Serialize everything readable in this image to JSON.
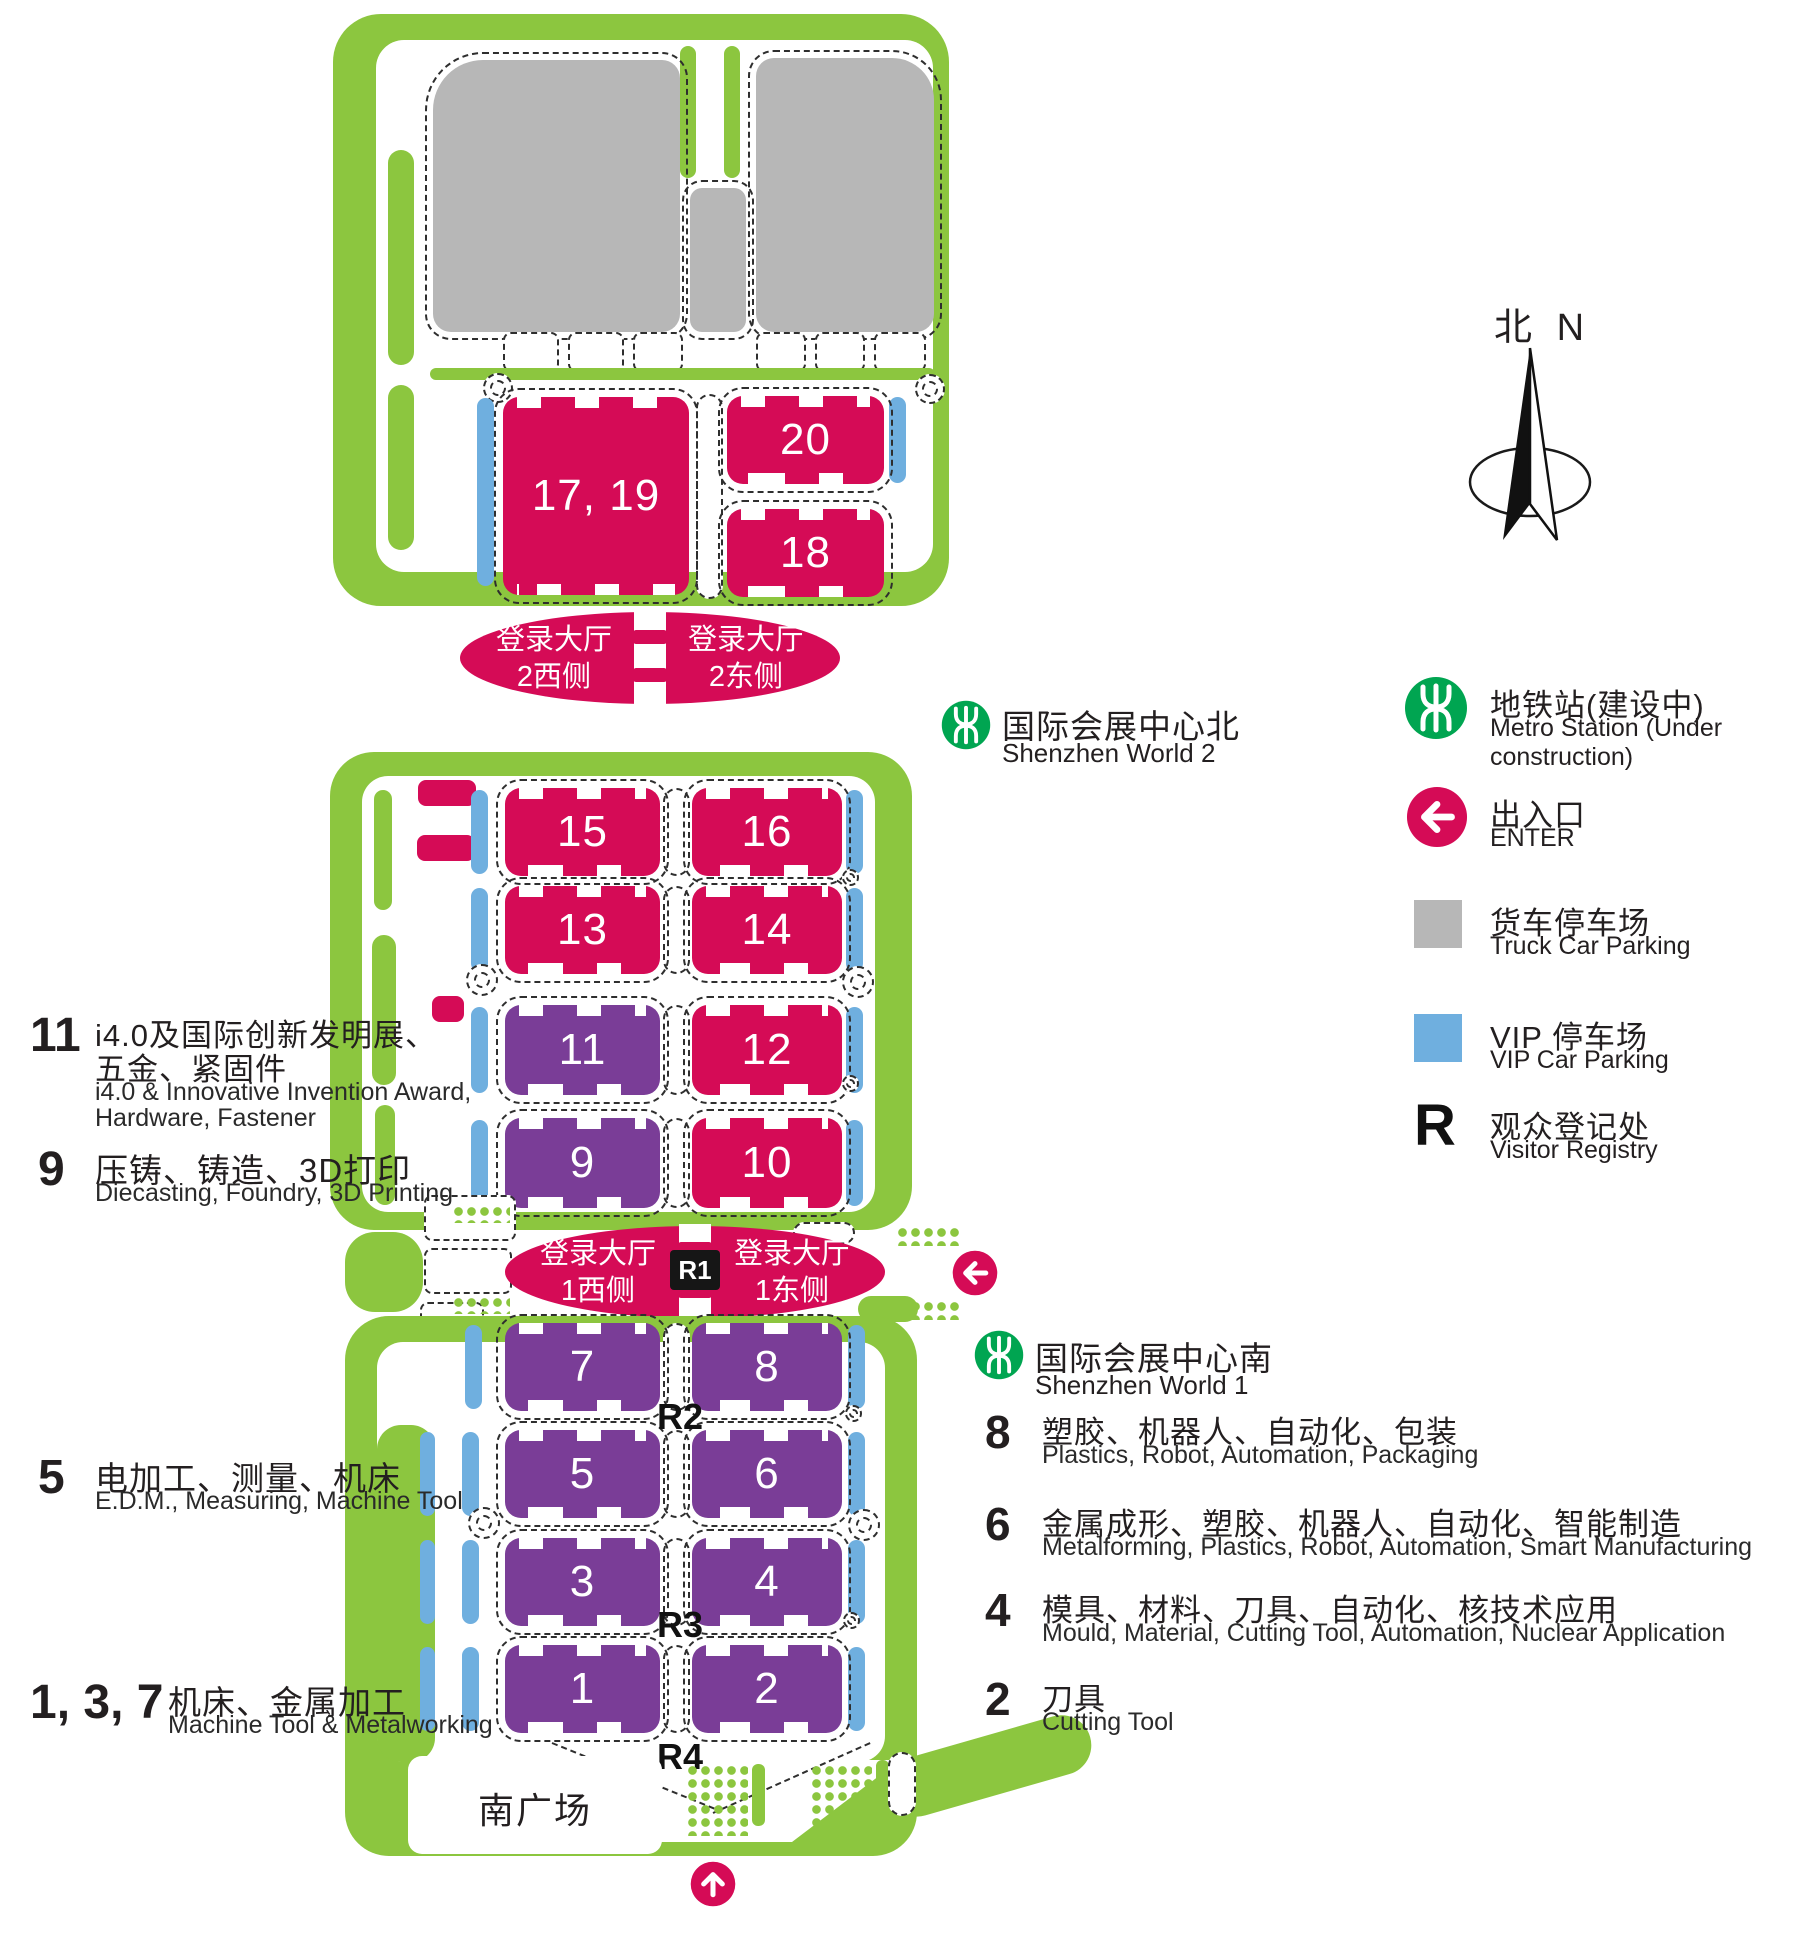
{
  "colors": {
    "landscape_green": "#8CC63F",
    "hall_pink": "#D50B56",
    "hall_purple": "#7A3D97",
    "vip_blue": "#6FAFDF",
    "truck_gray": "#B7B7B7",
    "metro_green": "#00A551",
    "text_ink": "#231F20"
  },
  "compass": {
    "zh": "北",
    "en": "N"
  },
  "halls": {
    "h17_19": "17, 19",
    "h20": "20",
    "h18": "18",
    "h15": "15",
    "h16": "16",
    "h13": "13",
    "h14": "14",
    "h11": "11",
    "h12": "12",
    "h9": "9",
    "h10": "10",
    "h7": "7",
    "h8": "8",
    "h5": "5",
    "h6": "6",
    "h3": "3",
    "h4": "4",
    "h1": "1",
    "h2": "2"
  },
  "lobbies": {
    "prefix": "登录大厅",
    "l2_west": "2西侧",
    "l2_east": "2东侧",
    "l1_west": "1西侧",
    "l1_east": "1东侧",
    "r1": "R1"
  },
  "roads": {
    "r2": "R2",
    "r3": "R3",
    "r4": "R4"
  },
  "plaza": "南广场",
  "stations": {
    "world2": {
      "zh": "国际会展中心北",
      "en": "Shenzhen World 2"
    },
    "world1": {
      "zh": "国际会展中心南",
      "en": "Shenzhen World 1"
    }
  },
  "categories_left": [
    {
      "num": "11",
      "zh1": "i4.0及国际创新发明展、",
      "zh2": "五金、紧固件",
      "en1": "i4.0 & Innovative Invention Award,",
      "en2": "Hardware, Fastener"
    },
    {
      "num": "9",
      "zh1": "压铸、铸造、3D打印",
      "en1": "Diecasting,  Foundry,  3D Printing"
    },
    {
      "num": "5",
      "zh1": "电加工、测量、机床",
      "en1": "E.D.M., Measuring, Machine Tool"
    },
    {
      "num": "1, 3, 7",
      "zh1": "机床、金属加工",
      "en1": "Machine Tool & Metalworking"
    }
  ],
  "categories_right": [
    {
      "num": "8",
      "zh": "塑胶、机器人、自动化、包装",
      "en": "Plastics,  Robot,  Automation,  Packaging"
    },
    {
      "num": "6",
      "zh": "金属成形、塑胶、机器人、自动化、智能制造",
      "en": "Metalforming,  Plastics,  Robot,  Automation,  Smart Manufacturing"
    },
    {
      "num": "4",
      "zh": "模具、材料、刀具、自动化、核技术应用",
      "en": "Mould,  Material, Cutting Tool,  Automation,  Nuclear Application"
    },
    {
      "num": "2",
      "zh": "刀具",
      "en": "Cutting Tool"
    }
  ],
  "legend": {
    "metro": {
      "zh": "地铁站(建设中)",
      "en": "Metro Station (Under construction)"
    },
    "enter": {
      "zh": "出入口",
      "en": "ENTER"
    },
    "truck": {
      "zh": "货车停车场",
      "en": "Truck Car Parking"
    },
    "vip": {
      "zh": "VIP 停车场",
      "en": "VIP Car Parking"
    },
    "registry": {
      "symbol": "R",
      "zh": "观众登记处",
      "en": "Visitor Registry"
    }
  }
}
